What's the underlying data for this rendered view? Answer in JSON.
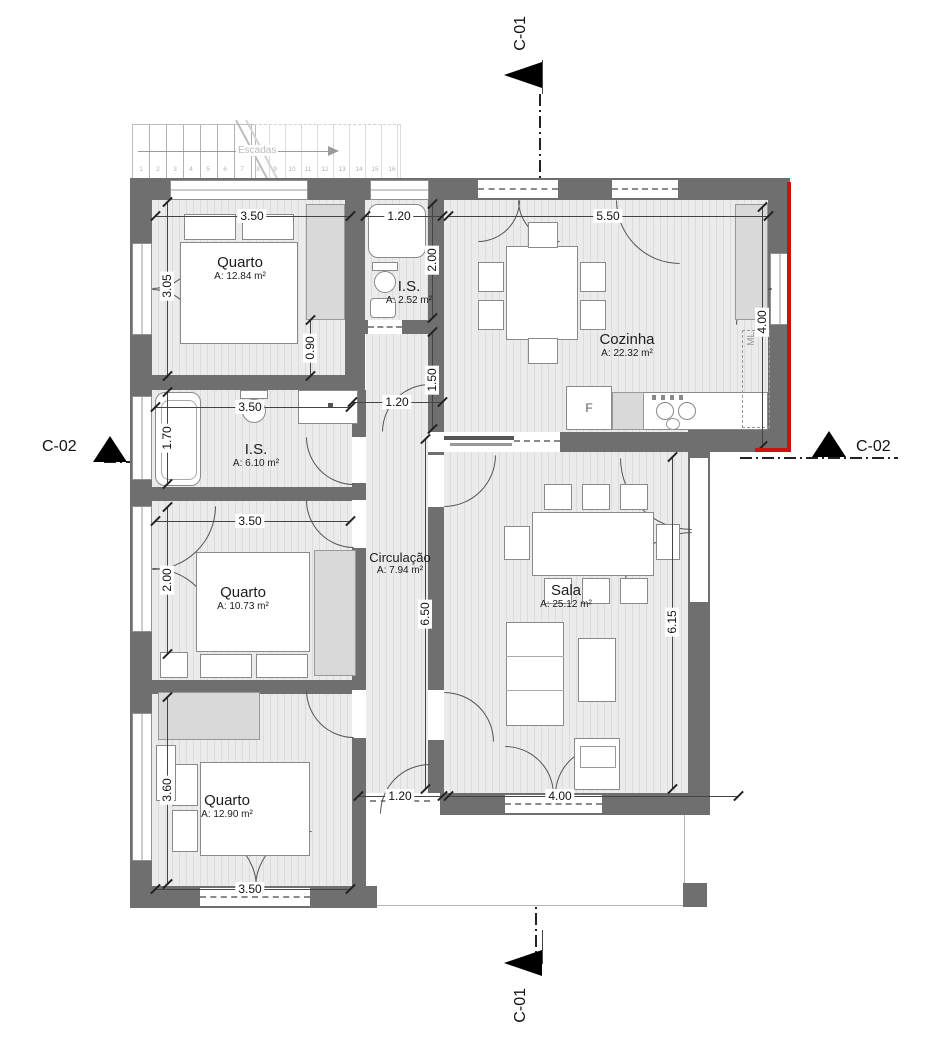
{
  "sections": {
    "c01": "C-01",
    "c02": "C-02"
  },
  "stairs": {
    "label": "Escadas",
    "numbers": [
      "1",
      "2",
      "3",
      "4",
      "5",
      "6",
      "7",
      "8",
      "9",
      "10",
      "11",
      "12",
      "13",
      "14",
      "15",
      "16"
    ]
  },
  "rooms": [
    {
      "id": "quarto1",
      "name": "Quarto",
      "area": "A: 12.84 m²"
    },
    {
      "id": "is-small",
      "name": "I.S.",
      "area": "A: 2.52 m²"
    },
    {
      "id": "cozinha",
      "name": "Cozinha",
      "area": "A: 22.32 m²"
    },
    {
      "id": "is-main",
      "name": "I.S.",
      "area": "A: 6.10 m²"
    },
    {
      "id": "quarto2",
      "name": "Quarto",
      "area": "A: 10.73 m²"
    },
    {
      "id": "circulacao",
      "name": "Circulação",
      "area": "A: 7.94 m²"
    },
    {
      "id": "sala",
      "name": "Sala",
      "area": "A: 25.12 m²"
    },
    {
      "id": "quarto3",
      "name": "Quarto",
      "area": "A: 12.90 m²"
    }
  ],
  "appliances": {
    "fridge": "F",
    "washing_machine": "ML"
  },
  "dimensions": {
    "q1_top": "3.50",
    "is_small_top": "1.20",
    "cozinha_top": "5.50",
    "q1_left": "3.05",
    "is_small_right": "2.00",
    "cozinha_right": "4.00",
    "hall_upper": "0.90",
    "hall_mid": "1.50",
    "hall_door_top": "1.20",
    "is_main_top": "3.50",
    "is_main_left": "1.70",
    "q2_top": "3.50",
    "q2_left": "2.00",
    "corridor_length": "6.50",
    "sala_right": "6.15",
    "q3_left": "3.60",
    "corridor_bottom": "1.20",
    "sala_bottom": "4.00",
    "q3_bottom": "3.50"
  },
  "colors": {
    "wall": "#6f6f6f",
    "section_red": "#cc1111",
    "floor": "#ebebeb"
  }
}
